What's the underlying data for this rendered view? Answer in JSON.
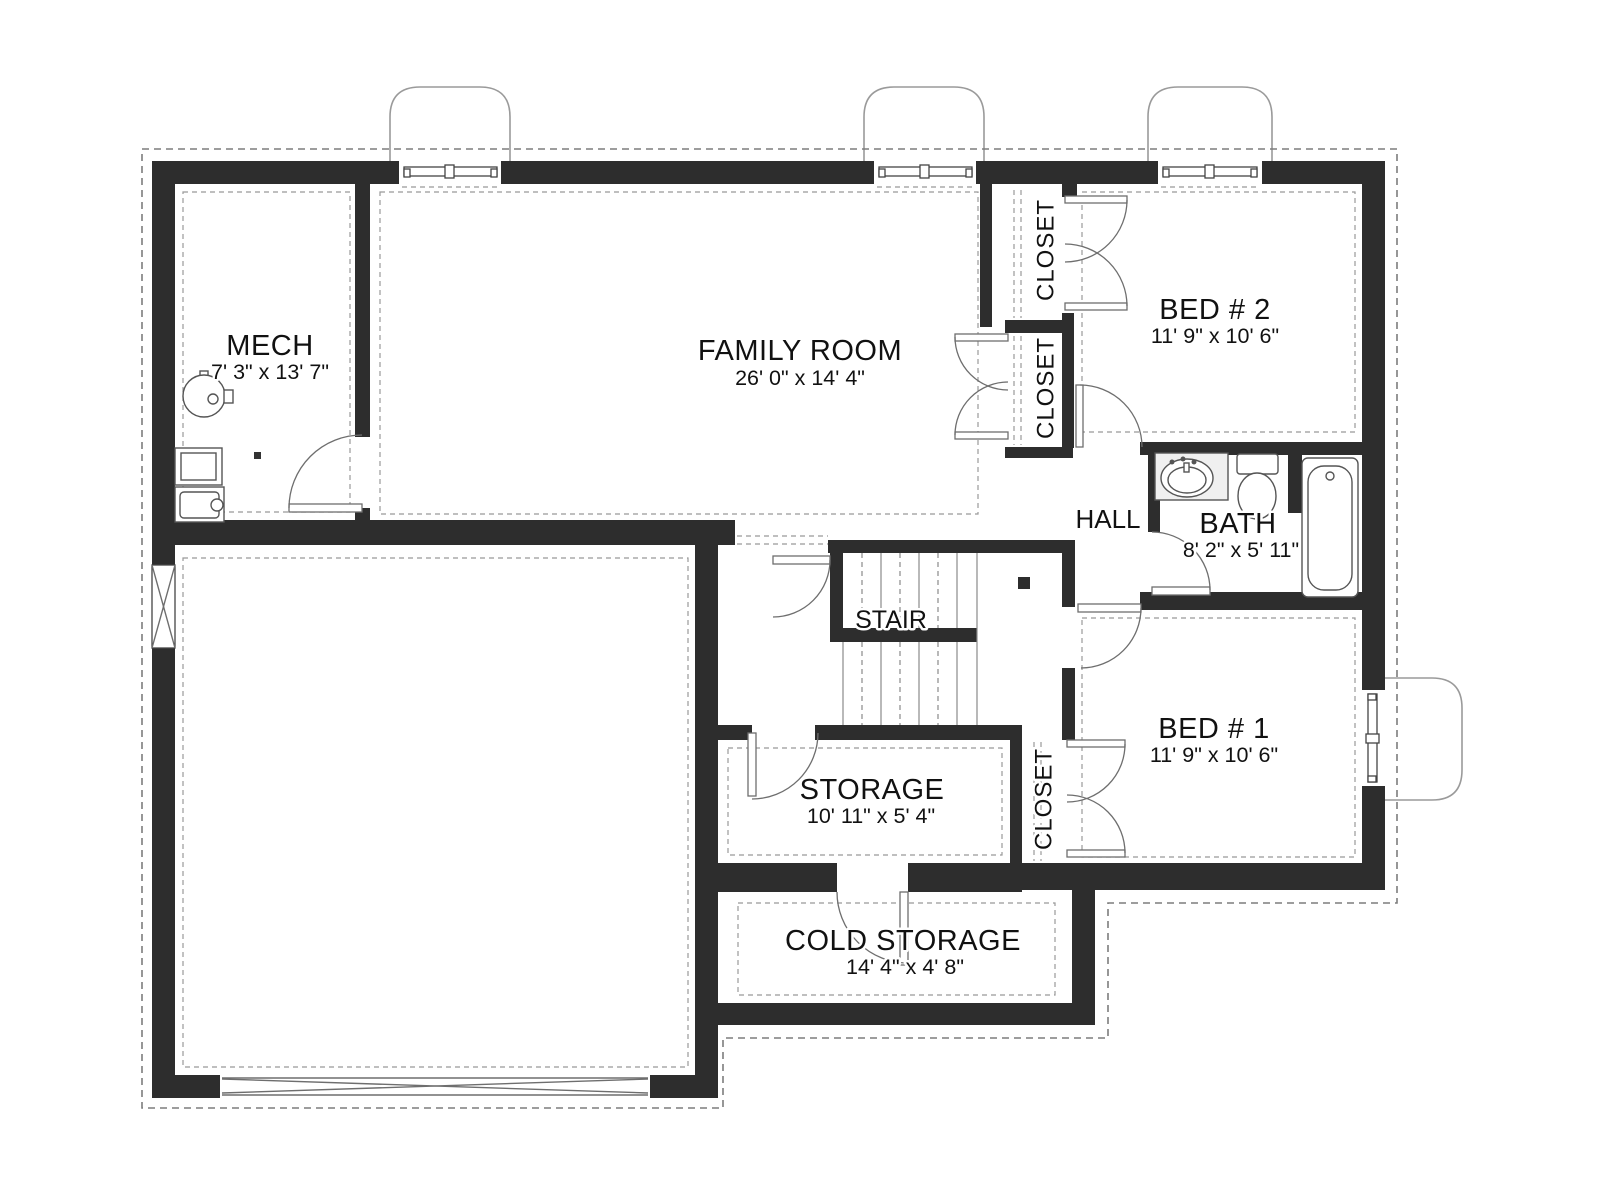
{
  "plan": {
    "type": "basement-floor-plan",
    "colors": {
      "wall": "#2d2d2d",
      "lines": "#6e6e6e",
      "dashed": "#7d7d7d",
      "text": "#111111",
      "fixture_fill": "#f0f0f0",
      "background": "#ffffff"
    },
    "rooms": {
      "mech": {
        "label": "MECH",
        "dims": "7' 3\" x 13' 7\""
      },
      "family_room": {
        "label": "FAMILY ROOM",
        "dims": "26' 0\" x 14' 4\""
      },
      "bed2": {
        "label": "BED # 2",
        "dims": "11' 9\" x 10' 6\""
      },
      "closet_bed2": {
        "label": "CLOSET"
      },
      "closet_family": {
        "label": "CLOSET"
      },
      "hall": {
        "label": "HALL"
      },
      "bath": {
        "label": "BATH",
        "dims": "8' 2\" x 5' 11\""
      },
      "stair": {
        "label": "STAIR"
      },
      "storage": {
        "label": "STORAGE",
        "dims": "10' 11\" x 5' 4\""
      },
      "closet_bed1": {
        "label": "CLOSET"
      },
      "bed1": {
        "label": "BED # 1",
        "dims": "11' 9\" x 10' 6\""
      },
      "cold_storage": {
        "label": "COLD STORAGE",
        "dims": "14' 4\" x 4' 8\""
      }
    },
    "fixtures": [
      "water-heater",
      "washer",
      "dryer",
      "floor-drain",
      "vanity-sink",
      "toilet",
      "bathtub"
    ],
    "features": [
      "egress-window-well-x3-top",
      "egress-window-well-bed1",
      "garage-door",
      "foundation-vent",
      "stairs"
    ]
  }
}
